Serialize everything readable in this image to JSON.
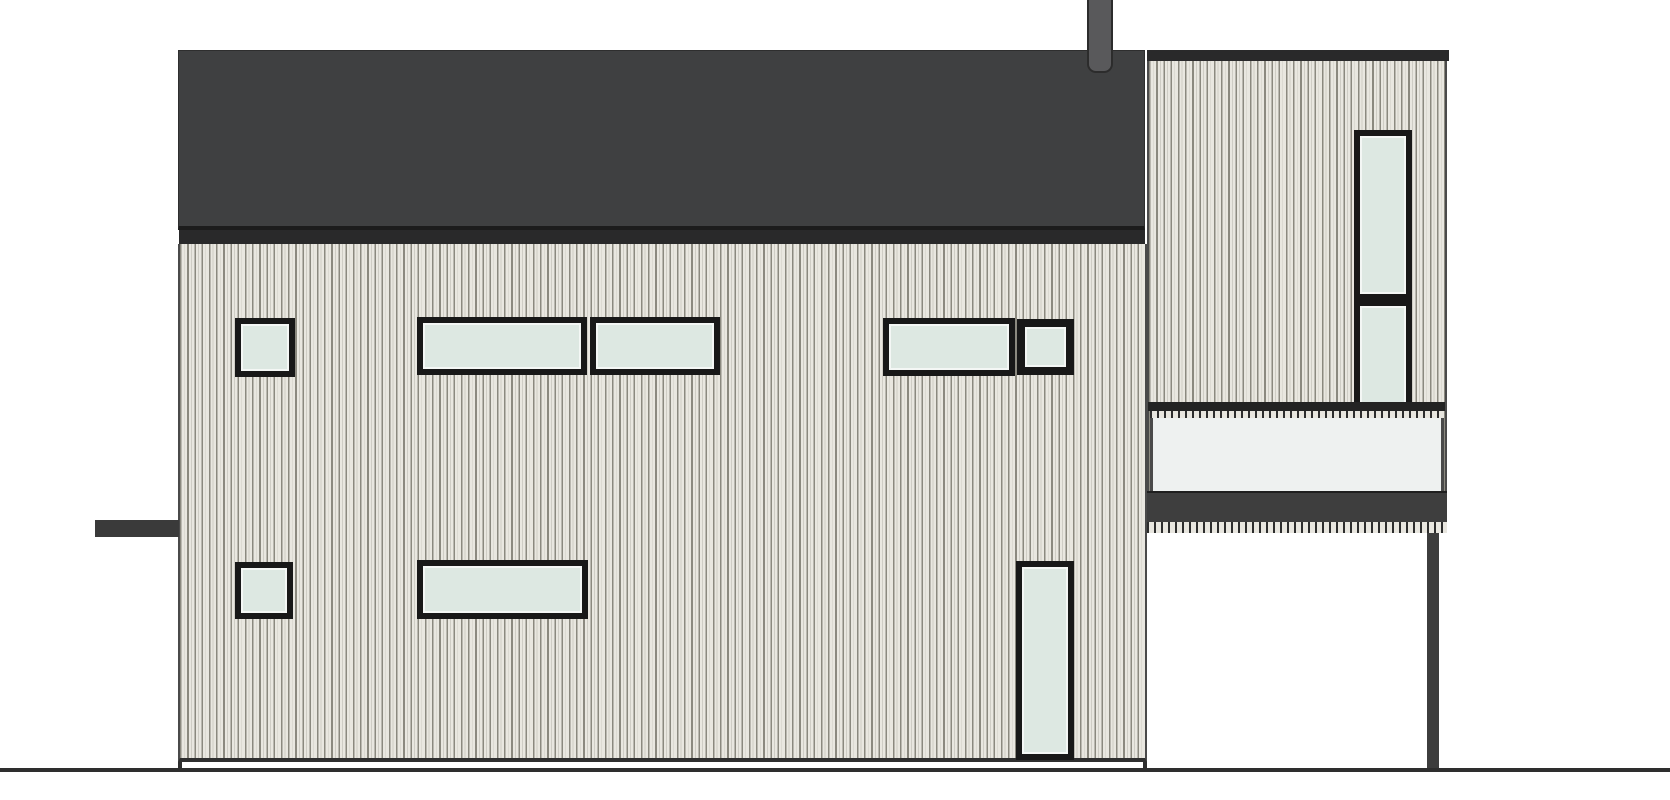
{
  "drawing": {
    "kind": "house-side-elevation",
    "canvas": {
      "width": 1670,
      "height": 800,
      "background": "#ffffff"
    }
  },
  "colors": {
    "roof": "#3f4041",
    "roof_edge": "#1c1c1c",
    "fascia": "#29292a",
    "chimney_fill": "#59595b",
    "chimney_outline": "#2c2c2c",
    "siding_light": "#e9e7e0",
    "siding_mid": "#cfcdc5",
    "siding_dark": "#8b897f",
    "outline": "#4a4a4a",
    "frame": "#181818",
    "glass": "#dde8e2",
    "glass_hilite": "#f4f7f5",
    "panel": "#eef1f0",
    "rail": "#232323",
    "dark_bar": "#3a3a3a",
    "balcony_fascia": "#3e3e3e",
    "post": "#3d3d3d",
    "ground": "#2e2e2e",
    "tick": "#2d2d2d"
  },
  "elements": [
    {
      "name": "main-roof",
      "type": "roof",
      "rect": [
        178,
        50,
        967,
        180
      ]
    },
    {
      "name": "roof-fascia",
      "type": "bar",
      "rect": [
        179,
        230,
        966,
        14
      ],
      "color": "fascia"
    },
    {
      "name": "chimney",
      "type": "chimney",
      "rect": [
        1087,
        0,
        26,
        73
      ]
    },
    {
      "name": "main-facade-siding",
      "type": "siding",
      "rect": [
        178,
        244,
        969,
        518
      ]
    },
    {
      "name": "left-canopy-bar",
      "type": "bar",
      "rect": [
        95,
        520,
        84,
        17
      ],
      "color": "dark_bar"
    },
    {
      "name": "foundation-step-left",
      "type": "bar",
      "rect": [
        178,
        762,
        4,
        8
      ],
      "color": "ground"
    },
    {
      "name": "foundation-step-right",
      "type": "bar",
      "rect": [
        1143,
        762,
        4,
        8
      ],
      "color": "ground"
    },
    {
      "name": "tower-siding",
      "type": "siding",
      "rect": [
        1147,
        61,
        300,
        472
      ]
    },
    {
      "name": "tower-parapet-cap",
      "type": "bar",
      "rect": [
        1147,
        50,
        302,
        11
      ],
      "color": "fascia"
    },
    {
      "name": "window-upper-left-small",
      "type": "window",
      "rect": [
        235,
        318,
        60,
        59
      ],
      "frame": 6
    },
    {
      "name": "window-upper-mid-left",
      "type": "window",
      "rect": [
        417,
        317,
        170,
        58
      ],
      "frame": 6
    },
    {
      "name": "window-upper-mid-right",
      "type": "window",
      "rect": [
        590,
        317,
        130,
        58
      ],
      "frame": 6
    },
    {
      "name": "window-upper-right-wide",
      "type": "window",
      "rect": [
        883,
        318,
        132,
        58
      ],
      "frame": 6
    },
    {
      "name": "window-upper-right-small",
      "type": "window",
      "rect": [
        1017,
        319,
        57,
        56
      ],
      "frame": 8
    },
    {
      "name": "window-lower-left-small",
      "type": "window",
      "rect": [
        235,
        562,
        58,
        57
      ],
      "frame": 6
    },
    {
      "name": "window-lower-mid-wide",
      "type": "window",
      "rect": [
        417,
        560,
        171,
        59
      ],
      "frame": 6
    },
    {
      "name": "window-tall-door",
      "type": "window",
      "rect": [
        1016,
        561,
        58,
        199
      ],
      "frame": 6
    },
    {
      "name": "tower-window-upper-sash",
      "type": "window",
      "rect": [
        1354,
        130,
        58,
        170
      ],
      "frame": 6
    },
    {
      "name": "tower-window-lower-sash",
      "type": "window",
      "rect": [
        1354,
        300,
        58,
        191
      ],
      "frame": 6
    },
    {
      "name": "balcony-rail",
      "type": "bar",
      "rect": [
        1148,
        402,
        297,
        9
      ],
      "color": "rail"
    },
    {
      "name": "balcony-panel",
      "type": "panel",
      "rect": [
        1150,
        412,
        294,
        79
      ]
    },
    {
      "name": "balcony-rail-ticks",
      "type": "ticks",
      "rect": [
        1150,
        411,
        294,
        7
      ]
    },
    {
      "name": "balcony-fascia",
      "type": "bar",
      "rect": [
        1147,
        491,
        300,
        31
      ],
      "color": "balcony_fascia"
    },
    {
      "name": "balcony-soffit-ticks",
      "type": "ticks",
      "rect": [
        1147,
        522,
        300,
        11
      ]
    },
    {
      "name": "balcony-post",
      "type": "bar",
      "rect": [
        1427,
        533,
        12,
        237
      ],
      "color": "post"
    },
    {
      "name": "ground-line",
      "type": "bar",
      "rect": [
        0,
        768,
        1670,
        4
      ],
      "color": "ground"
    }
  ]
}
